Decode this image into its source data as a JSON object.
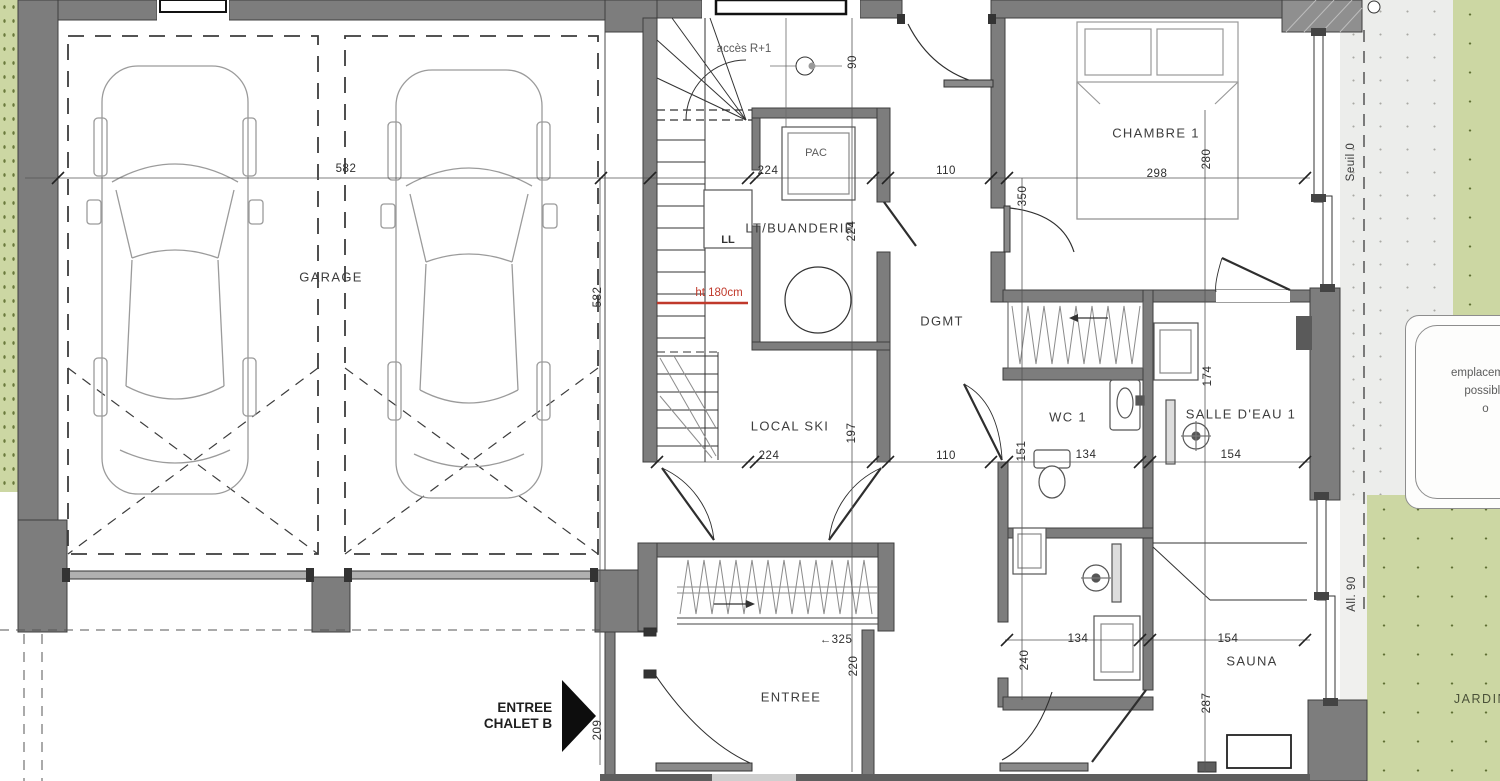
{
  "colors": {
    "wall": "#7d7d7d",
    "garden": "#ccd7a3",
    "terrace": "#ecedeb",
    "accent_red": "#c0392b",
    "line": "#3a3a3a"
  },
  "rooms": {
    "garage": "GARAGE",
    "chambre1": "CHAMBRE 1",
    "buanderie": "LT/BUANDERIE",
    "pac": "PAC",
    "dgmt": "DGMT",
    "wc1": "WC 1",
    "salle_deau1": "SALLE D'EAU 1",
    "local_ski": "LOCAL SKI",
    "sauna": "SAUNA",
    "entree": "ENTREE"
  },
  "labels": {
    "ll": "LL",
    "acces_r1": "accès R+1",
    "ht180": "ht 180cm",
    "entree_chalet_l1": "ENTREE",
    "entree_chalet_l2": "CHALET B",
    "seuil": "Seuil 0",
    "allege": "All. 90",
    "jardin": "JARDIN",
    "emplacement_l1": "emplacement",
    "emplacement_l2": "possible",
    "emplacement_l3": "o"
  },
  "dims": {
    "garage_w": "582",
    "garage_h": "582",
    "stair_w": "224",
    "dgmt_w": "110",
    "chambre_w": "298",
    "door_top": "90",
    "chambre_h": "280",
    "dgmt_h": "350",
    "buanderie_h": "224",
    "sde_h": "174",
    "localski_w": "224",
    "localski_h": "197",
    "dgmt_w2": "110",
    "wc_h": "151",
    "wc_w": "134",
    "sde_w": "154",
    "hall_w": "325",
    "entree_h": "220",
    "bath2_h": "240",
    "bath2_w": "134",
    "sauna_w": "154",
    "sauna_h": "287",
    "entree_side": "209"
  },
  "icons": {
    "arrow_left": "←",
    "arrow_right": "→"
  }
}
